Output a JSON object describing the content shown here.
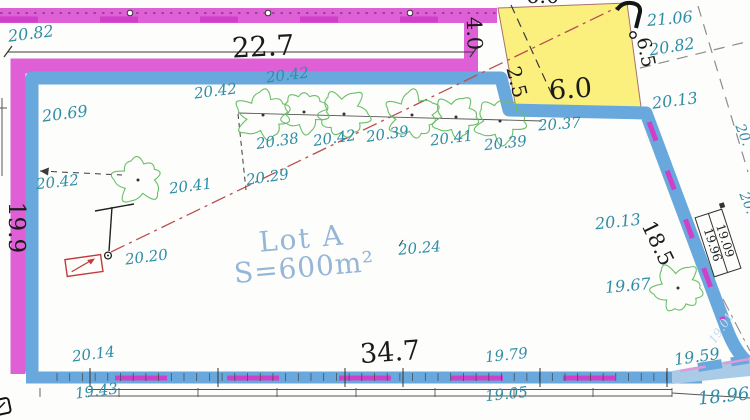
{
  "lot": {
    "name": "Lot A",
    "area": "S=600m²"
  },
  "labels": {
    "e20_82_tl": "20.82",
    "dim_top": "22.7",
    "gap_4_0": "4.0",
    "e21_06": "21.06",
    "e20_82_r": "20.82",
    "dim_6_5": "6.5",
    "sq_6_0_top": "6.0",
    "sq_2_5": "2.5",
    "sq_6_0": "6.0",
    "e20_13_a": "20.13",
    "e20_69": "20.69",
    "e20_42_a": "20.42",
    "e20_42_b": "20.42",
    "e20_38": "20.38",
    "e20_42_c": "20.42",
    "e20_39_a": "20.39",
    "e20_41_a": "20.41",
    "e20_39_b": "20.39",
    "e20_37": "20.37",
    "e20_42_d": "20.42",
    "e20_41_b": "20.41",
    "e20_29": "20.29",
    "e20_20": "20.20",
    "e20_24": "20.24",
    "e20_13_b": "20.13",
    "dim_18_5": "18.5",
    "e19_67": "19.67",
    "box_19_09": "19.09",
    "box_19_96": "19.96",
    "e19_59": "19.59",
    "e18_96": "18.96",
    "e19_01": "19.01",
    "e20_14": "20.14",
    "e19_43": "19.43",
    "dim_bottom": "34.7",
    "e19_79": "19.79",
    "e19_05": "19.05",
    "dim_left": "19.9",
    "edge_20_a": "20.",
    "edge_20_b": "20."
  },
  "colors": {
    "boundary_blue": "#69a8dc",
    "boundary_magenta": "#df5fd7",
    "parcel_yellow": "#fbf07e",
    "label_teal": "#2f8da6",
    "tree_green": "#6abf6a",
    "axis_red": "#b85050",
    "lot_text": "#96b6d8"
  }
}
